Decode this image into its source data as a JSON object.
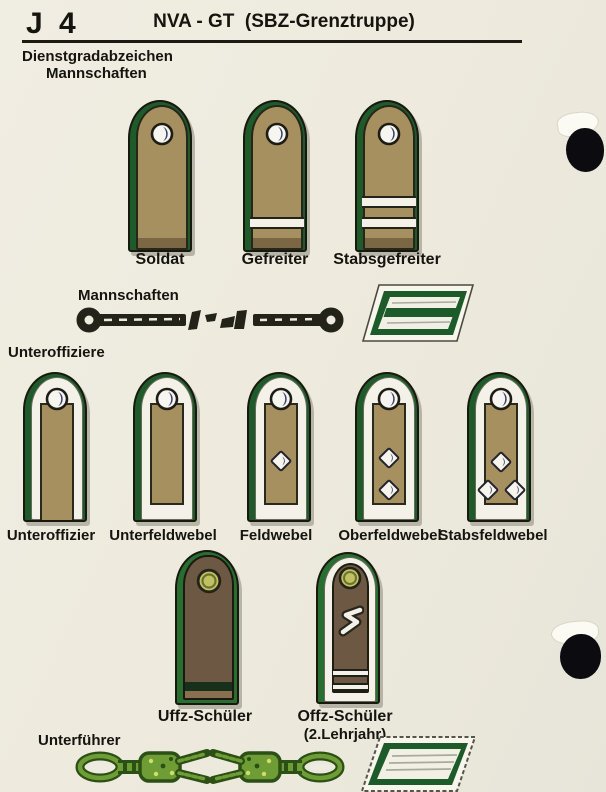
{
  "header": {
    "code": "J 4",
    "title": "NVA - GT  (SBZ-Grenztruppe)"
  },
  "headings": {
    "line1": "Dienstgradabzeichen",
    "line2": "Mannschaften"
  },
  "section_labels": {
    "mannschaften": "Mannschaften",
    "unteroffiziere": "Unteroffiziere",
    "unterfuehrer": "Unterführer"
  },
  "row1": [
    {
      "label": "Soldat",
      "stripes": 0
    },
    {
      "label": "Gefreiter",
      "stripes": 1
    },
    {
      "label": "Stabsgefreiter",
      "stripes": 2
    }
  ],
  "row2": [
    {
      "label": "Unteroffizier",
      "pips": 0,
      "braid_open_bottom": true
    },
    {
      "label": "Unterfeldwebel",
      "pips": 0,
      "braid_open_bottom": false
    },
    {
      "label": "Feldwebel",
      "pips": 1,
      "braid_open_bottom": false
    },
    {
      "label": "Oberfeldwebel",
      "pips": 2,
      "braid_open_bottom": false
    },
    {
      "label": "Stabsfeldwebel",
      "pips": 3,
      "braid_open_bottom": false
    }
  ],
  "row3": [
    {
      "label": "Uffz-Schüler"
    },
    {
      "label": "Offz-Schüler",
      "sublabel": "(2.Lehrjahr)"
    }
  ],
  "icons": {
    "button_silver": "uniform-button-silver",
    "button_olive": "uniform-button-olive",
    "rank_pip": "rank-pip-diamond",
    "collar_patch_top": "collar-patch-enlisted",
    "collar_patch_bottom": "collar-patch-unterfuehrer",
    "cord_dark": "shoulder-cord-dark",
    "cord_green": "knot-cord-green"
  },
  "colors": {
    "page_bg": "#edeadd",
    "piping_green": "#1e5a2a",
    "board_tan": "#a6905f",
    "braid_white": "#f4f2e8",
    "cadet_brown": "#6d5943",
    "button_navy": "#39406a",
    "button_olive": "#bec263",
    "cord_dark": "#23231a",
    "cord_green": "#6f9d35",
    "ink": "#15140f"
  }
}
